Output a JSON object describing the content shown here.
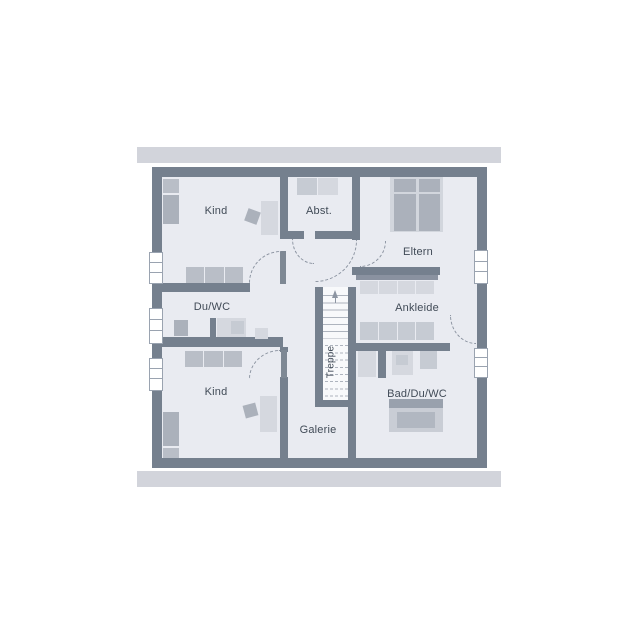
{
  "floor_plan": {
    "rooms": {
      "kind_top": {
        "label": "Kind"
      },
      "abst": {
        "label": "Abst."
      },
      "eltern": {
        "label": "Eltern"
      },
      "du_wc": {
        "label": "Du/WC"
      },
      "ankleide": {
        "label": "Ankleide"
      },
      "kind_bottom": {
        "label": "Kind"
      },
      "bad_du_wc": {
        "label": "Bad/Du/WC"
      },
      "galerie": {
        "label": "Galerie"
      }
    },
    "stairs": {
      "label": "Treppe",
      "direction": "up"
    },
    "colors": {
      "eave": "#d2d4db",
      "wall": "#75808e",
      "floor": "#e9ebf1",
      "furn_light": "#d5d8df",
      "furn_med": "#abb1bb",
      "furn_med2": "#b9bec7",
      "furn_soft": "#c6cbd3",
      "rail": "#8a92a0",
      "tread": "#aeb4be",
      "stairbg": "#f8f9fb",
      "arc": "#8d95a2",
      "leaf": "#7e8894",
      "winline": "#9aa3b0",
      "ink": "#414b57",
      "bed_frame": "#d2d6dd",
      "tub_shelf": "#99a1ad",
      "tub_outer": "#c9cdd5",
      "tub_inner": "#b1b7c1"
    }
  }
}
